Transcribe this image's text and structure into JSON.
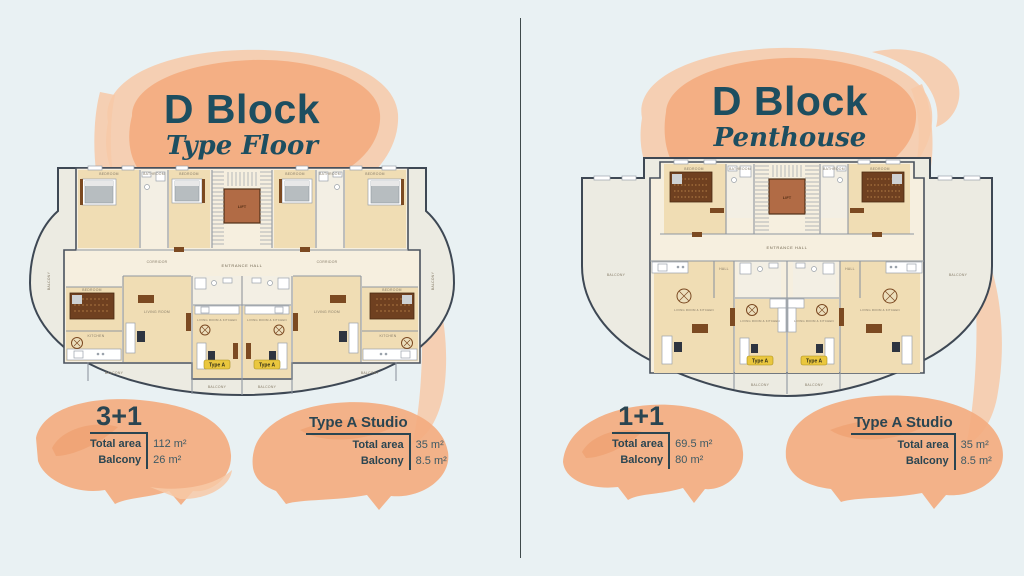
{
  "colors": {
    "background": "#e9f1f3",
    "title": "#1d4e60",
    "text": "#2a4551",
    "value_text": "#3e5a64",
    "divider": "#3f4a4b",
    "watercolor_light": "#f7c9a7",
    "watercolor_main": "#f3ac80",
    "watercolor_deep": "#ec9a68",
    "plan_outline": "#3e4854",
    "plan_floor": "#f6efdf",
    "plan_wood": "#f0ddb4",
    "plan_bath_floor": "#f3efe4",
    "plan_balcony": "#ecebe2",
    "plan_wall": "#8f97a1",
    "furniture_brown": "#7c4a22",
    "lift_fill": "#b16b45",
    "type_a_bg": "#eac73e"
  },
  "left_panel": {
    "title": "D Block",
    "subtitle": "Type Floor",
    "unit_info": {
      "name": "3+1",
      "rows": [
        {
          "label": "Total area",
          "value": "112 m²"
        },
        {
          "label": "Balcony",
          "value": "26 m²"
        }
      ]
    },
    "studio_info": {
      "name": "Type A Studio",
      "rows": [
        {
          "label": "Total area",
          "value": "35 m²"
        },
        {
          "label": "Balcony",
          "value": "8.5 m²"
        }
      ]
    }
  },
  "right_panel": {
    "title": "D Block",
    "subtitle": "Penthouse",
    "unit_info": {
      "name": "1+1",
      "rows": [
        {
          "label": "Total area",
          "value": "69.5 m²"
        },
        {
          "label": "Balcony",
          "value": "80 m²"
        }
      ]
    },
    "studio_info": {
      "name": "Type A Studio",
      "rows": [
        {
          "label": "Total area",
          "value": "35 m²"
        },
        {
          "label": "Balcony",
          "value": "8.5 m²"
        }
      ]
    }
  },
  "plan_labels": {
    "bedroom": "BEDROOM",
    "bathroom": "BATHROOM",
    "corridor": "CORRIDOR",
    "hall": "HALL",
    "living_room": "LIVING ROOM",
    "kitchen": "KITCHEN",
    "living_room_kitchen": "LIVING ROOM & KITCHEN",
    "entrance_hall": "ENTRANCE HALL",
    "lift": "LIFT",
    "balcony": "BALCONY",
    "type_a": "Type A"
  }
}
